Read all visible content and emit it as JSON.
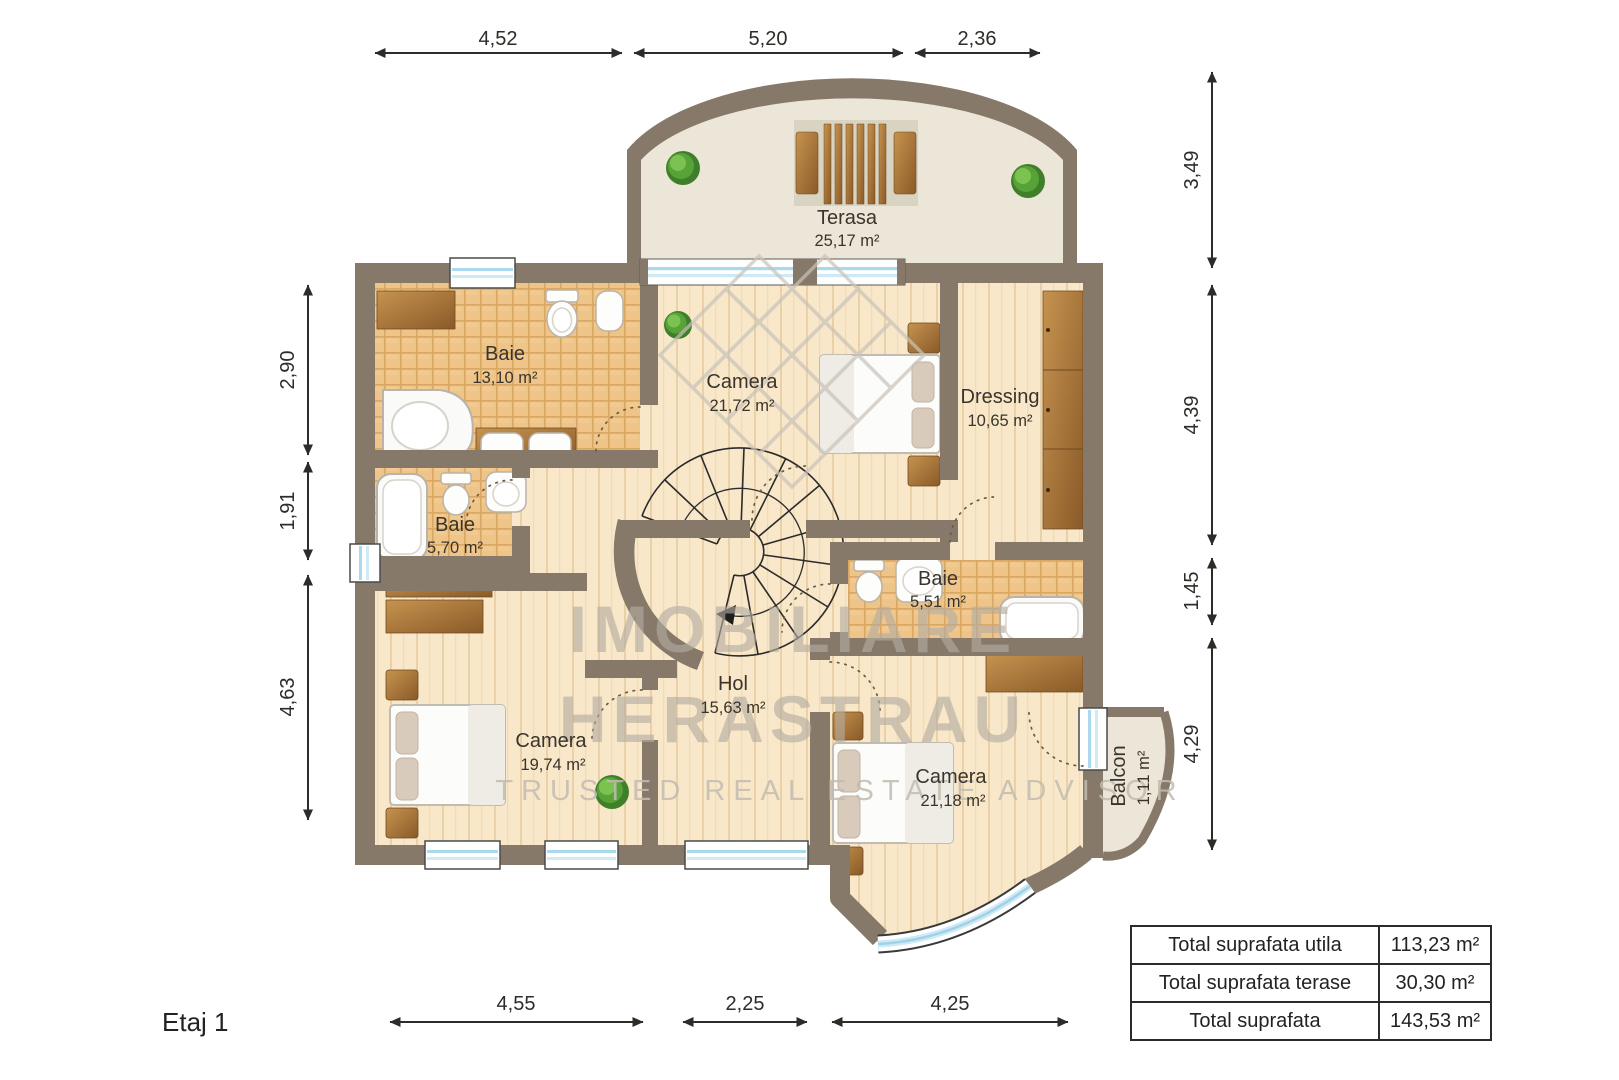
{
  "floor_label": "Etaj 1",
  "rooms": {
    "terasa": {
      "name": "Terasa",
      "area": "25,17 m²"
    },
    "baie_mare": {
      "name": "Baie",
      "area": "13,10 m²"
    },
    "camera_top": {
      "name": "Camera",
      "area": "21,72 m²"
    },
    "dressing": {
      "name": "Dressing",
      "area": "10,65 m²"
    },
    "baie_mica": {
      "name": "Baie",
      "area": "5,70 m²"
    },
    "baie_51": {
      "name": "Baie",
      "area": "5,51 m²"
    },
    "hol": {
      "name": "Hol",
      "area": "15,63 m²"
    },
    "camera_stanga": {
      "name": "Camera",
      "area": "19,74 m²"
    },
    "camera_dreapta": {
      "name": "Camera",
      "area": "21,18 m²"
    },
    "balcon": {
      "name": "Balcon",
      "area": "1,11 m²"
    }
  },
  "dimensions": {
    "top": [
      "4,52",
      "5,20",
      "2,36"
    ],
    "right": [
      "3,49",
      "4,39",
      "1,45",
      "4,29"
    ],
    "left": [
      "2,90",
      "1,91",
      "4,63"
    ],
    "bottom": [
      "4,55",
      "2,25",
      "4,25"
    ]
  },
  "watermark": {
    "line1": "IMOBILIARE",
    "line2": "HERASTRAU",
    "tagline": "TRUSTED REAL ESTATE ADVISOR"
  },
  "summary_table": {
    "rows": [
      {
        "label": "Total suprafata utila",
        "value": "113,23 m²"
      },
      {
        "label": "Total suprafata terase",
        "value": "30,30 m²"
      },
      {
        "label": "Total suprafata",
        "value": "143,53 m²"
      }
    ]
  },
  "colors": {
    "wall": "#87796a",
    "wood_floor": "#f8e7c9",
    "tile_floor": "#eec488",
    "terrace_floor": "#ebe6d7",
    "furniture_wood": "#a9742f",
    "watermark_gray": "#b3aca1",
    "glass_blue": "#a9d9ee",
    "dimension_ink": "#2e2c29"
  }
}
